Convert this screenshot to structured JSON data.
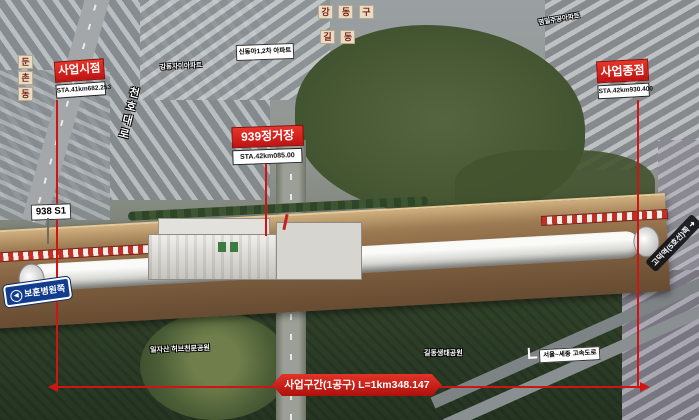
{
  "annotations": {
    "start": {
      "title": "사업시점",
      "sta": "STA.41km682.253"
    },
    "station": {
      "title": "939정거장",
      "sta": "STA.42km085.00"
    },
    "end": {
      "title": "사업종점",
      "sta": "STA.42km930.400"
    },
    "shaft_label": "938 S1",
    "section_banner": "사업구간(1공구) L=1km348.147"
  },
  "signs": {
    "bohun": {
      "arrow": "◀",
      "text": "보훈병원쪽"
    },
    "godeok": {
      "text": "고덕역(5호선)쪽",
      "arrow": "➜"
    },
    "expressway": "서울~세종 고속도로"
  },
  "places": {
    "dunchon": [
      "둔",
      "촌",
      "동"
    ],
    "gangdonggu": [
      "강",
      "동",
      "구"
    ],
    "gildong": [
      "길",
      "동"
    ],
    "cheonho_daero": "천호대로",
    "gangdong_xi": "강동자이아파트",
    "shindonga": "신동아1,2차 아파트",
    "myeongil": "명일주공아파트",
    "iljasan": "일자산 허브천문공원",
    "gildong_eco": "길동생태공원"
  },
  "colors": {
    "annotation_red": "#cf1511",
    "sign_blue": "#123d8f",
    "earth_brown": "#7b5c3d",
    "tape_red_white": "#c03025"
  }
}
